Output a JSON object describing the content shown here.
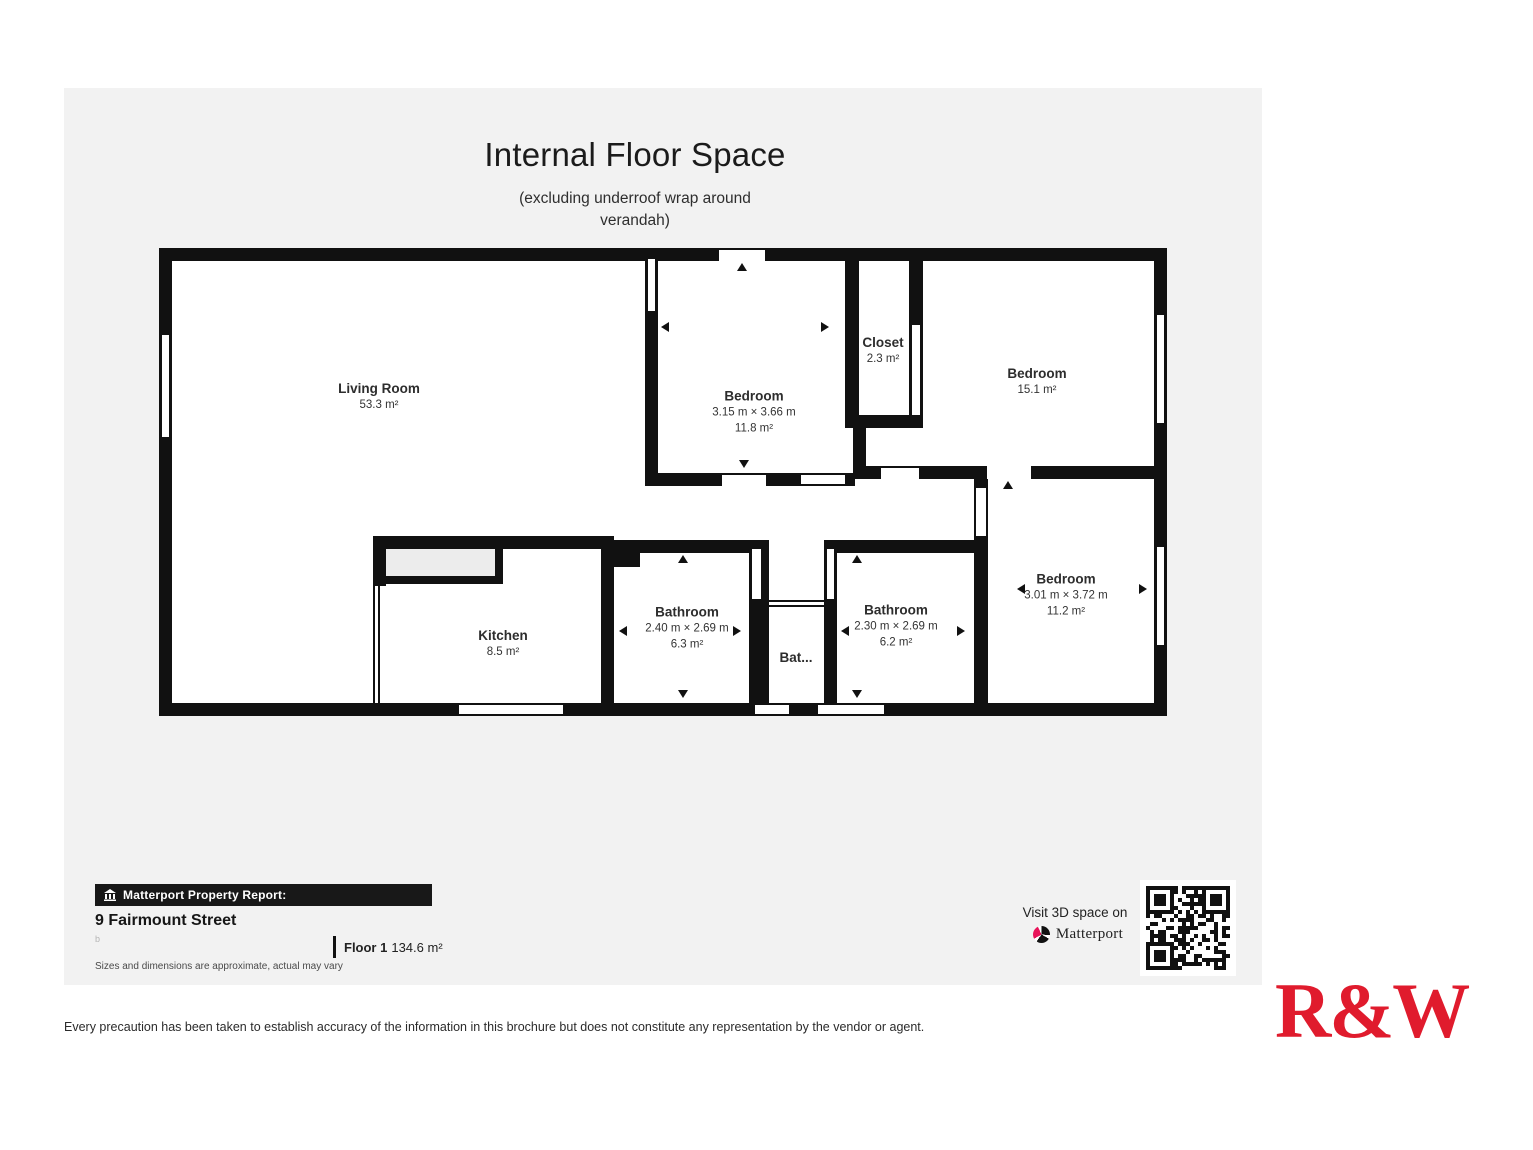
{
  "title": "Internal Floor Space",
  "subtitle_line1": "(excluding underroof wrap around",
  "subtitle_line2": "verandah)",
  "rooms": [
    {
      "name": "Living Room",
      "area": "53.3 m²"
    },
    {
      "name": "Bedroom",
      "dims": "3.15 m × 3.66 m",
      "area": "11.8 m²"
    },
    {
      "name": "Closet",
      "area": "2.3 m²"
    },
    {
      "name": "Bedroom",
      "area": "15.1 m²"
    },
    {
      "name": "Kitchen",
      "area": "8.5 m²"
    },
    {
      "name": "Bathroom",
      "dims": "2.40 m × 2.69 m",
      "area": "6.3 m²"
    },
    {
      "name": "Bat..."
    },
    {
      "name": "Bathroom",
      "dims": "2.30 m × 2.69 m",
      "area": "6.2 m²"
    },
    {
      "name": "Bedroom",
      "dims": "3.01 m × 3.72 m",
      "area": "11.2 m²"
    }
  ],
  "report": {
    "bar_label": "Matterport Property Report:",
    "address": "9 Fairmount Street",
    "stray_mark": "b",
    "floor_label": "Floor 1",
    "floor_area": "134.6 m²",
    "note": "Sizes and dimensions are approximate, actual may vary"
  },
  "cta": {
    "visit": "Visit 3D space on",
    "brand": "Matterport"
  },
  "disclaimer": "Every precaution has been taken to establish accuracy of the information in this brochure but does not constitute any representation by the vendor or agent.",
  "logo": "R&W",
  "colors": {
    "canvas": "#f2f2f2",
    "wall": "#111111",
    "brand_red": "#e01b2d",
    "matterport_pink": "#e8145a"
  }
}
